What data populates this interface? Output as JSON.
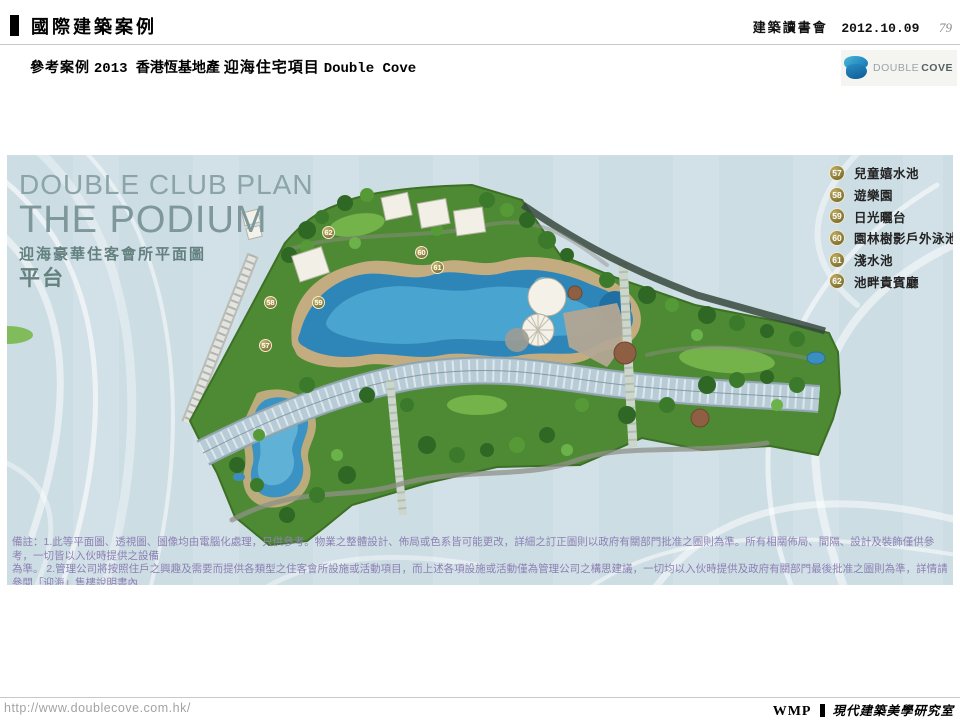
{
  "header": {
    "title": "國際建築案例",
    "event": "建築讀書會",
    "date": "2012.10.09",
    "page_number": "79"
  },
  "subheader": {
    "prefix": "參考案例",
    "year_developer": "2013 香港恆基地產",
    "project": "迎海住宅項目",
    "project_en": "Double Cove"
  },
  "logo": {
    "name_light": "DOUBLE",
    "name_dark": "COVE"
  },
  "plan": {
    "title_en_line1": "DOUBLE CLUB PLAN",
    "title_en_line2": "THE PODIUM",
    "title_zh_line1": "迎海豪華住客會所平面圖",
    "title_zh_line2": "平台"
  },
  "legend": {
    "items": [
      {
        "number": "57",
        "label": "兒童嬉水池"
      },
      {
        "number": "58",
        "label": "遊樂園"
      },
      {
        "number": "59",
        "label": "日光曬台"
      },
      {
        "number": "60",
        "label": "園林樹影戶外泳池"
      },
      {
        "number": "61",
        "label": "淺水池"
      },
      {
        "number": "62",
        "label": "池畔貴賓廳"
      }
    ]
  },
  "plan_markers": [
    {
      "number": "57"
    },
    {
      "number": "58"
    },
    {
      "number": "59"
    },
    {
      "number": "60"
    },
    {
      "number": "61"
    },
    {
      "number": "62"
    }
  ],
  "disclaimer": {
    "line1": "備註：1.此等平面圖、透視圖、圖像均由電腦化處理，只供參考。物業之整體設計、佈局或色系皆可能更改，詳細之訂正圖則以政府有關部門批准之圖則為準。所有相關佈局、間隔、設計及裝飾僅供參考，一切皆以入伙時提供之設備",
    "line2": "為準。 2.管理公司將按照住戶之興趣及需要而提供各類型之住客會所設施或活動項目，而上述各項設施或活動僅為管理公司之構思建議，一切均以入伙時提供及政府有關部門最後批准之圖則為準，詳情請參閱「迎海」售樓說明書內",
    "line3": "之相關平面圖，而有關之批准圖則亦可於「迎海」售樓處免費查閱。"
  },
  "footer": {
    "url": "http://www.doublecove.com.hk/",
    "brand": "WMP",
    "studio": "現代建築美學研究室"
  },
  "colors": {
    "panel_background": "#ccdde4",
    "legend_badge_gold": "#8a7b38",
    "pool_blue": "#2e86b8",
    "site_green": "#4e8a33",
    "disclaimer_purple": "#8d80b3",
    "logo_blue": "#1273b5"
  }
}
